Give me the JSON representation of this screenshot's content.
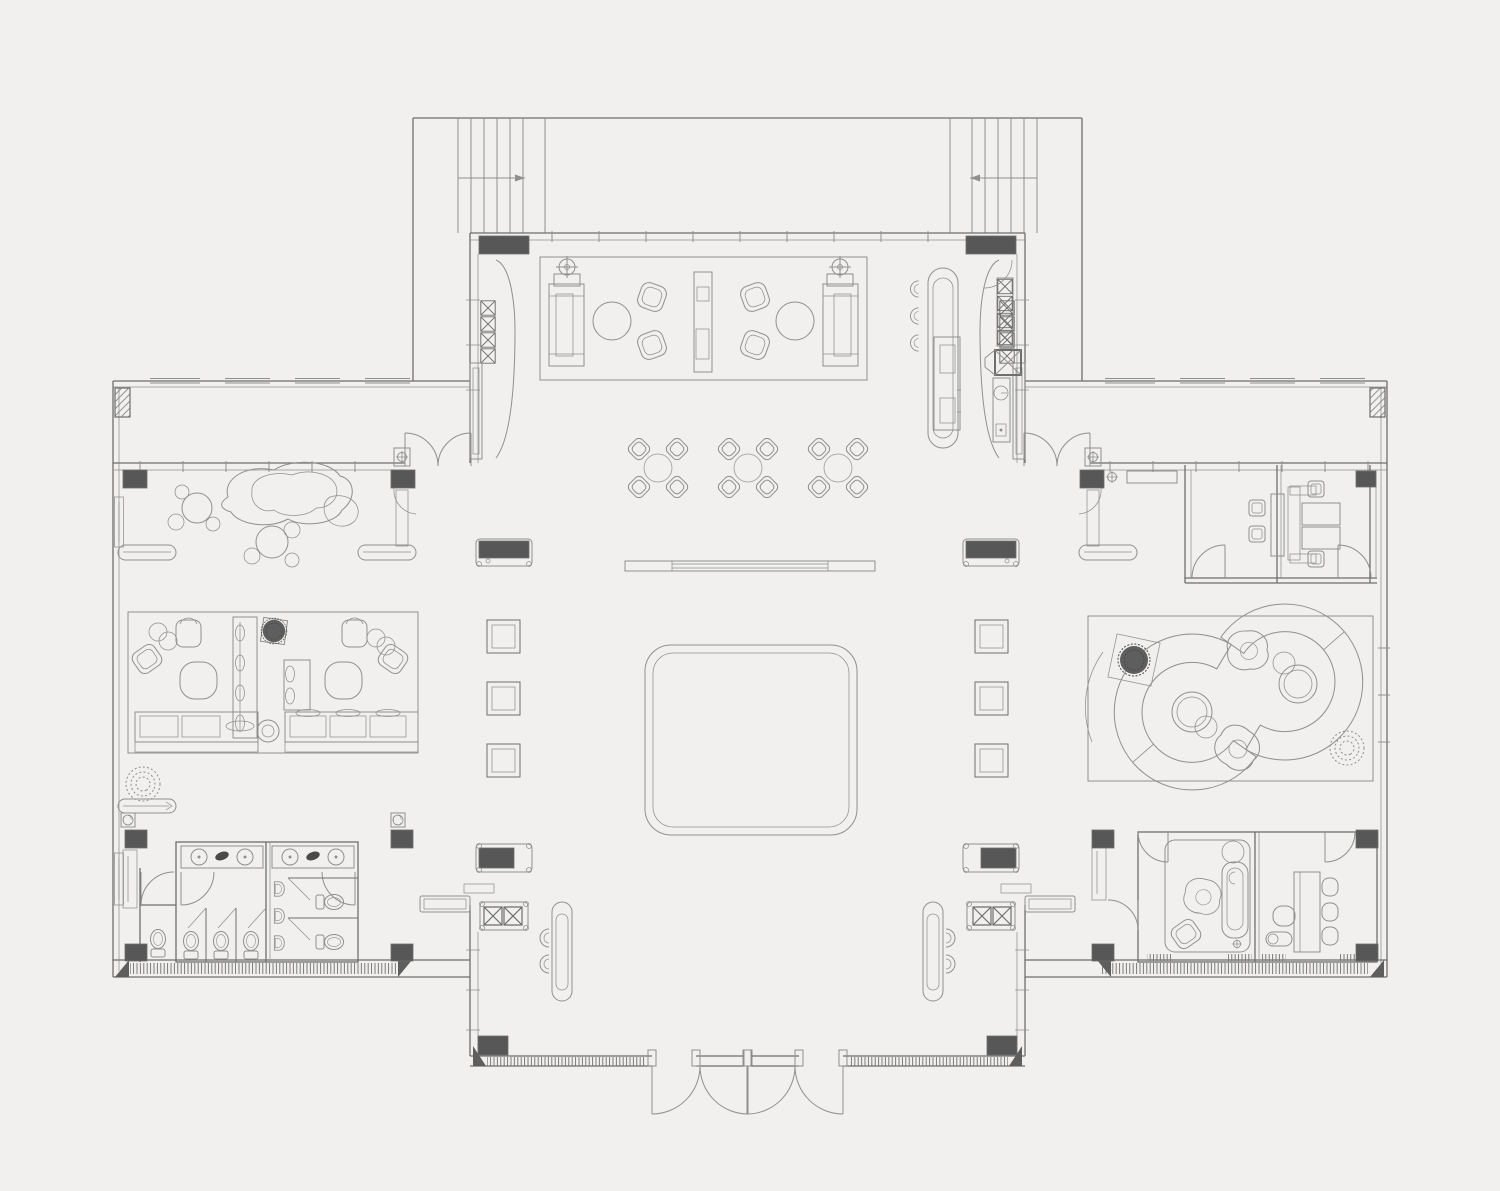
{
  "meta": {
    "type": "architectural-floor-plan",
    "view": "top-down",
    "drawing_style": "cad-line-drawing"
  },
  "colors": {
    "background": "#f1f0ee",
    "line": "#8f8f8f",
    "wall": "#6e6e6e",
    "dark_fill": "#575757",
    "accent_dark": "#4a4a4a"
  },
  "counts": {
    "stair_flights": 2,
    "stair_treads_per_flight": 6,
    "dining_sets": 3,
    "chairs_per_dining_set": 4,
    "entrance_door_leaves": 4,
    "vestibule_double_doors": 2,
    "bar_stools": 3,
    "colonnade_square_columns_per_side": 3,
    "toilet_fixtures": 6,
    "urinals": 3,
    "sink_basins": 4,
    "exhaust_fans": 2,
    "floor_lamps": 2,
    "crescent_sofas": 2,
    "plants": 5
  },
  "regions": {
    "top_terrace": {
      "features": [
        "stair-flight-left",
        "stair-flight-right",
        "direction-arrow-left",
        "direction-arrow-right"
      ]
    },
    "central_hall": {
      "features": [
        "lounge-rug",
        "sofa-pair",
        "floor-lamps",
        "round-coffee-tables",
        "armchairs",
        "center-console",
        "bar-counter",
        "bar-stools",
        "bar-back-cabinet",
        "dining-sets",
        "long-console-table",
        "central-carpet",
        "colonnade-piers",
        "square-columns",
        "entrance-planters",
        "entrance-stools",
        "main-doors",
        "door-mats"
      ]
    },
    "left_wing": {
      "features": [
        "sculpture-display",
        "stone-seat-clusters",
        "lounge-room",
        "l-shaped-sofas",
        "round-tables",
        "banquette-screen",
        "planter-box",
        "barrel-chairs",
        "bench-seats",
        "floor-plant",
        "exhaust-fans",
        "restroom-block",
        "vanity-counters",
        "sink-basins",
        "toilet-stalls",
        "urinals",
        "accessible-stalls",
        "wc-room"
      ]
    },
    "right_wing": {
      "features": [
        "meeting-room-left",
        "meeting-room-right",
        "meeting-table",
        "desk-chairs",
        "privacy-screen",
        "wall-console",
        "curved-lounge-room",
        "crescent-sofas",
        "round-coffee-tables",
        "blob-chairs",
        "plants",
        "spa-room",
        "massage-bed",
        "spa-rug",
        "work-room",
        "work-table",
        "work-chairs"
      ]
    }
  }
}
